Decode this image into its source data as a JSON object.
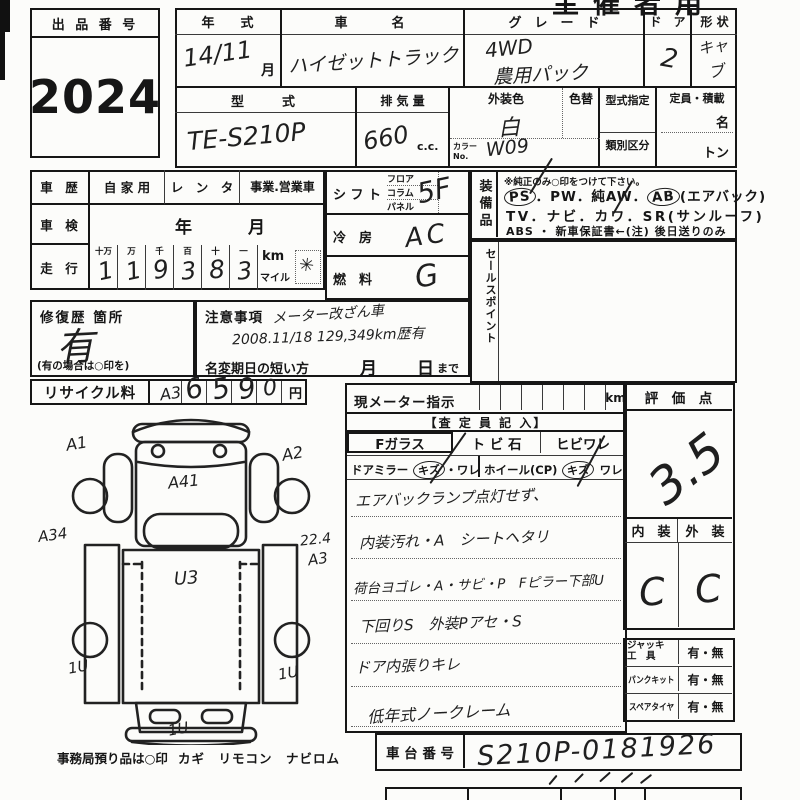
{
  "colors": {
    "ink": "#161616",
    "pen": "#1f1f1f",
    "paper": "#fcfcfa"
  },
  "header": {
    "use_label": "主催者用"
  },
  "auction": {
    "label": "出 品 番 号",
    "number": "2024"
  },
  "vehicle": {
    "year_label": "年　　式",
    "year_value": "14/11",
    "month": "月",
    "name_label": "車　　名",
    "name_value": "ハイゼットトラック",
    "grade_label": "グ　レ　ー　ド",
    "grade_line1": "4WD",
    "grade_line2": "農用パック",
    "door_label": "ド　ア",
    "door_value": "2",
    "shape_label": "形 状",
    "shape_value_1": "キャ",
    "shape_value_2": "ブ",
    "model_label": "型　　式",
    "model_value": "TE-S210P",
    "disp_label": "排 気 量",
    "disp_value": "660",
    "disp_unit": "c.c.",
    "color_label": "外装色",
    "color_value": "白",
    "color_change_label": "色替",
    "color_no_label_1": "カラー",
    "color_no_label_2": "No.",
    "color_no_value": "W09",
    "type_desig_label": "型式指定",
    "class_label": "類別区分",
    "capacity_label": "定員・積載",
    "capacity_persons": "名",
    "capacity_tons": "トン"
  },
  "history": {
    "label": "車　歴",
    "opt_private": "自 家 用",
    "opt_rental": "レ　ン　タ",
    "opt_business": "事業.営業車",
    "inspection_label": "車　検",
    "inspection_year": "年",
    "inspection_month": "月",
    "mileage_label": "走　行",
    "digit_headers": [
      "十万",
      "万",
      "千",
      "百",
      "十",
      "一"
    ],
    "digits": [
      "1",
      "1",
      "9",
      "3",
      "8",
      "3"
    ],
    "unit_km": "km",
    "unit_mile": "マイル",
    "unit_mark": "✳"
  },
  "drive": {
    "shift_label": "シ フ ト",
    "shift_opt1": "フロア",
    "shift_opt2": "コラム",
    "shift_opt3": "パネル",
    "shift_value": "5F",
    "cooling_label": "冷　房",
    "cooling_value": "AC",
    "fuel_label": "燃　料",
    "fuel_value": "G"
  },
  "equipment": {
    "label": "装備品",
    "note": "※純正のみ○印をつけて下さい。",
    "ps": "PS",
    "mid1": "．PW．純AW．",
    "ab": "AB",
    "ab_note": "(エアバック)",
    "line2": "TV．ナビ．カワ．SR(サンルーフ)",
    "line3": "ABS ・ 新車保証書←(注) 後日送りのみ"
  },
  "sales_point": {
    "label": "セールスポイント"
  },
  "repair": {
    "label": "修復歴 箇所",
    "value": "有",
    "note": "(有の場合は○印を)"
  },
  "caution": {
    "label": "注意事項",
    "line1": "メーター改ざん車",
    "line2": "2008.11/18 129,349km歴有",
    "rename_label": "名変期日の短い方",
    "month": "月",
    "day": "日",
    "until": "まで"
  },
  "recycle": {
    "label": "リサイクル料",
    "digits": [
      "6",
      "5",
      "9",
      "0"
    ],
    "unit": "円"
  },
  "meter": {
    "label": "現メーター指示",
    "unit": "km",
    "assessor": "【査 定 員 記 入】",
    "f_glass": "Fガラス",
    "stone_chip": "ト ビ 石",
    "crack": "ヒビワレ",
    "door_mirror": "ドアミラー",
    "mirror_kizu": "キズ",
    "mirror_ware": "・ワレ",
    "wheel": "ホイール(CP)",
    "wheel_kizu": "キズ",
    "wheel_ware": "ワレ"
  },
  "notes": {
    "line1": "エアバックランプ点灯せず、",
    "line2": "内装汚れ・A　シートヘタリ",
    "line3": "荷台ヨゴレ・A・サビ・P　Fピラー下部U",
    "line4": "下回りS　外装Pアセ・S",
    "line5": "ドア内張りキレ",
    "line6": "低年式ノークレーム"
  },
  "score": {
    "label": "評　価　点",
    "value": "3.5",
    "interior_label": "内　装",
    "exterior_label": "外　装",
    "interior_value": "C",
    "exterior_value": "C"
  },
  "tools": {
    "jack_label_1": "ジャッキ",
    "jack_label_2": "工　具",
    "jack_value": "有・無",
    "puncture_label": "パンクキット",
    "puncture_value": "有・無",
    "spare_label": "スペアタイヤ",
    "spare_value": "有・無"
  },
  "chassis": {
    "label": "車 台 番 号",
    "value": "S210P-0181926"
  },
  "diagram": {
    "front": "A3",
    "left_front": "A1",
    "right_front": "A2",
    "cab": "A41",
    "left_side": "A34",
    "right_side_a": "22.4",
    "right_side_b": "A3",
    "bed": "U3",
    "rear_left": "1U",
    "rear_right": "1U",
    "rear_bottom": "1U",
    "deposit_note": "事務局預り品は○印",
    "deposit_items": "カギ　リモコン　ナビロム"
  }
}
